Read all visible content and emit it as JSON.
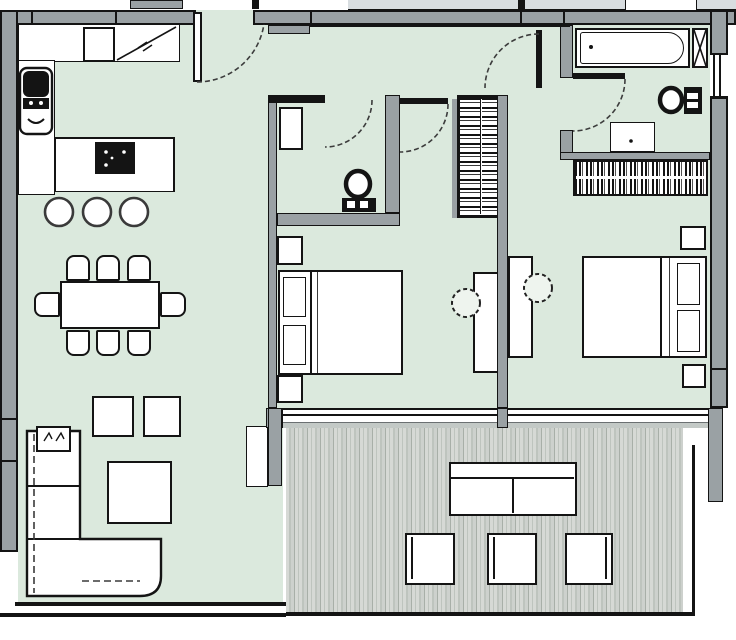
{
  "title": "apartment-floor-plan",
  "colors": {
    "floor": "#dbe9dd",
    "wall": "#9aa1a4",
    "line": "#141414",
    "arc": "#3c3c3c",
    "exterior": "#d8dde0",
    "deck_light": "#d6d9d5",
    "deck_light2": "#cdd1cd",
    "deck_mid": "#bec4be",
    "deck_dark": "#a8afa8"
  },
  "legend": {
    "rooms": [
      "living-dining-kitchen",
      "entrance-hall",
      "wc",
      "bedroom-1",
      "bedroom-2",
      "bathroom",
      "terrace"
    ],
    "fixtures": [
      {
        "name": "entrance-door",
        "count": 1
      },
      {
        "name": "coat-closet",
        "count": 1
      },
      {
        "name": "kitchen-counter",
        "count": 1
      },
      {
        "name": "kitchen-sink",
        "count": 1
      },
      {
        "name": "cooktop",
        "count": 1
      },
      {
        "name": "bar-stool",
        "count": 3
      },
      {
        "name": "dining-table",
        "count": 1
      },
      {
        "name": "dining-chair",
        "count": 8
      },
      {
        "name": "l-shaped-sofa",
        "count": 1
      },
      {
        "name": "coffee-table",
        "count": 1
      },
      {
        "name": "ottoman",
        "count": 2
      },
      {
        "name": "double-bed",
        "count": 2
      },
      {
        "name": "nightstand",
        "count": 4
      },
      {
        "name": "desk",
        "count": 2
      },
      {
        "name": "desk-chair",
        "count": 2
      },
      {
        "name": "wardrobe",
        "count": 2
      },
      {
        "name": "toilet",
        "count": 2
      },
      {
        "name": "washbasin",
        "count": 2
      },
      {
        "name": "bathtub",
        "count": 1
      },
      {
        "name": "duct-shaft",
        "count": 1
      },
      {
        "name": "window",
        "count": 3
      },
      {
        "name": "door-swing",
        "count": 5
      },
      {
        "name": "outdoor-sofa",
        "count": 1
      },
      {
        "name": "outdoor-chair",
        "count": 3
      },
      {
        "name": "terrace-decking",
        "count": 1
      }
    ]
  }
}
